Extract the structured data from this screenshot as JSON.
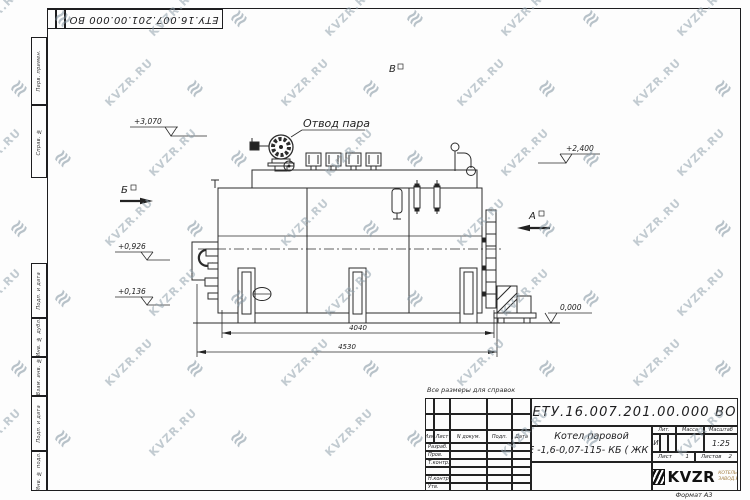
{
  "watermark": {
    "text": "KVZR.RU",
    "logo_glyph": "≋"
  },
  "sheet": {
    "top_stamp": "ЕТУ.16.007.201.00.000  ВО",
    "format_note": "Формат А3",
    "reference_note": "Все размеры для справок",
    "margin_labels": [
      "Перв. примен.",
      "Справ. №",
      "Подп. и дата",
      "Инв. № дубл.",
      "Взам. инв. №",
      "Подп. и дата",
      "Инв. № подл."
    ]
  },
  "drawing": {
    "steam_outlet_label": "Отвод пара",
    "views": {
      "b": "Б",
      "a": "А",
      "v": "В"
    },
    "elevations": {
      "e1": "+3,070",
      "e2": "+2,400",
      "e3": "+0,926",
      "e4": "+0,136",
      "e5": "0,000"
    },
    "dimensions": {
      "d1": "4040",
      "d2": "4530"
    }
  },
  "title_block": {
    "designation": "ЕТУ.16.007.201.00.000  ВО",
    "name_line1": "Котел паровой",
    "name_line2": "Е -1,6-0,07-115- КБ ( ЖК )",
    "columns": {
      "izm": "Изм",
      "list": "Лист",
      "doc": "N докум.",
      "sign": "Подп.",
      "date": "Дата"
    },
    "rows": {
      "razrab": "Разраб.",
      "prov": "Пров.",
      "tkontr": "Т.контр.",
      "nkontr": "Н.контр.",
      "utv": "Утв."
    },
    "stat": {
      "lit_header": "Лит.",
      "mass_header": "Масса",
      "scale_header": "Масштаб",
      "lit": "И",
      "scale": "1:25"
    },
    "sheets": {
      "sheet_label": "Лист",
      "sheet_value": "1",
      "sheets_label": "Листов",
      "sheets_value": "2"
    },
    "logo": {
      "text": "KVZR",
      "sub1": "КОТЕЛЬНЫЙ",
      "sub2": "ЗАВОД.РУ"
    }
  }
}
